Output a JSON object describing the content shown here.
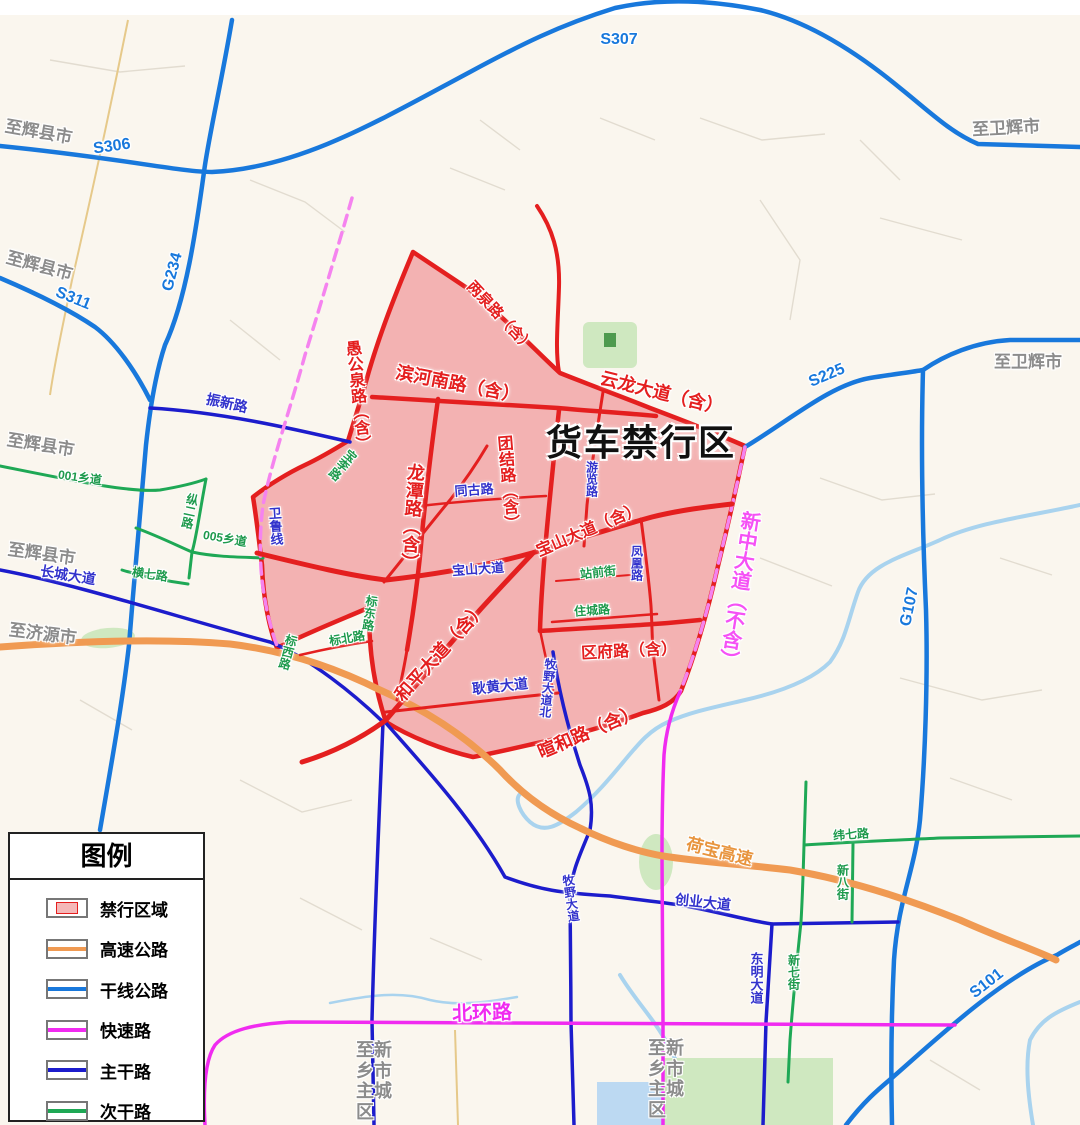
{
  "legend": {
    "title": "图例",
    "items": [
      {
        "label": "禁行区域",
        "fill": "#f5b8b8",
        "border": "#e41f1f"
      },
      {
        "label": "高速公路",
        "color": "#f09a52"
      },
      {
        "label": "干线公路",
        "color": "#1878dc"
      },
      {
        "label": "快速路",
        "color": "#f02bf0"
      },
      {
        "label": "主干路",
        "color": "#1c1ccc"
      },
      {
        "label": "次干路",
        "color": "#1ea855"
      }
    ]
  },
  "colors": {
    "zone_fill": "#f3b2b2",
    "zone_road": "#e41f1f",
    "trunk_road": "#1878dc",
    "major_road": "#1c1ccc",
    "secondary_road": "#1ea855",
    "fast_road": "#f02bf0",
    "highway": "#f09a52",
    "river": "#a9d3ee"
  },
  "labels": {
    "title": "货车禁行区",
    "s306": "S306",
    "s307": "S307",
    "s311": "S311",
    "g234": "G234",
    "s225": "S225",
    "g107": "G107",
    "s101": "S101",
    "to_huixian": "至辉县市",
    "to_jiyuan": "至济源市",
    "to_weihui": "至卫辉市",
    "to_xinxiang": "至新乡市主城区",
    "liangquan": "两泉路（含）",
    "yugongquan": "愚公泉路（含）",
    "binhenan": "滨河南路（含）",
    "yunlong": "云龙大道（含）",
    "tuanjie": "团结路（含）",
    "longtan": "龙潭路（含）",
    "baoshan_inc": "宝山大道（含）",
    "baoshan": "宝山大道",
    "heping": "和平大道（含）",
    "qufu": "区府路（含）",
    "xuanhe": "暄和路（含）",
    "xinzhong": "新中大道（不含）",
    "tonggu": "同古路",
    "youlan": "游览路",
    "fenghuang": "凤凰路",
    "zhanqian": "站前街",
    "zhucheng": "住城路",
    "genghuang": "耿黄大道",
    "muye_bei": "牧野大道北",
    "muye": "牧野大道",
    "chuangye": "创业大道",
    "dongming": "东明大道",
    "zhenxin": "振新路",
    "changcheng": "长城大道",
    "weilu": "卫鲁线",
    "baoli": "宝李路",
    "biaodong": "标东路",
    "biaobei": "标北路",
    "biaoxi": "标西路",
    "x001": "001乡道",
    "zong2": "纵二路",
    "x005": "005乡道",
    "heng7": "横七路",
    "wei7": "纬七路",
    "xinba": "新八街",
    "xinqi": "新七街",
    "hebao": "荷宝高速",
    "beihuan": "北环路"
  }
}
